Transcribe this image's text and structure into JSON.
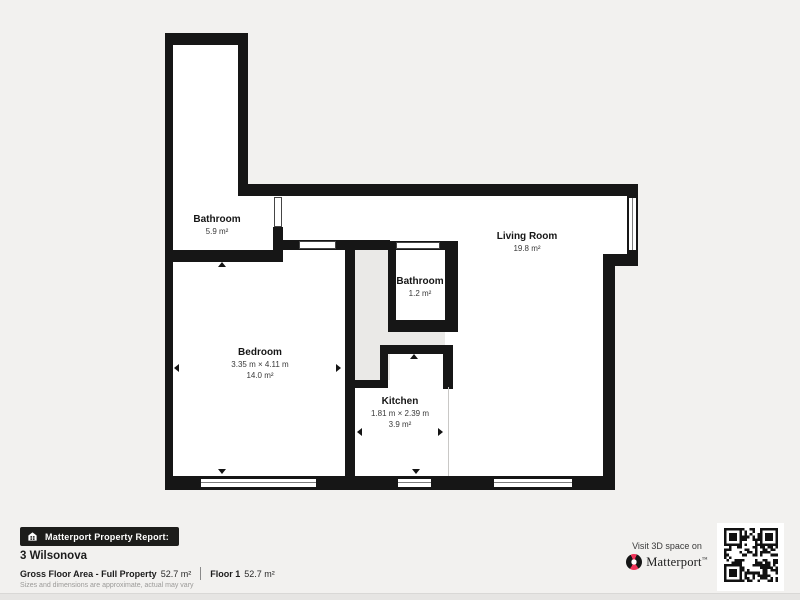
{
  "report": {
    "badge": "Matterport Property Report:",
    "property_name": "3 Wilsonova",
    "gross_floor_area_label": "Gross Floor Area - Full Property",
    "gross_floor_area_value": "52.7 m²",
    "floor_label": "Floor 1",
    "floor_value": "52.7 m²",
    "disclaimer": "Sizes and dimensions are approximate, actual may vary"
  },
  "rooms": {
    "bathroom_main": {
      "name": "Bathroom",
      "area": "5.9 m²"
    },
    "living_room": {
      "name": "Living Room",
      "area": "19.8 m²"
    },
    "bathroom_small": {
      "name": "Bathroom",
      "area": "1.2 m²"
    },
    "bedroom": {
      "name": "Bedroom",
      "dimensions": "3.35 m × 4.11 m",
      "area": "14.0 m²"
    },
    "kitchen": {
      "name": "Kitchen",
      "dimensions": "1.81 m × 2.39 m",
      "area": "3.9 m²"
    }
  },
  "cta": {
    "visit_text": "Visit 3D space on",
    "brand": "Matterport",
    "trademark": "™"
  },
  "icons": {
    "badge_icon": "house-icon",
    "logo": "matterport-logo-icon",
    "qr": "qr-code"
  },
  "colors": {
    "wall": "#161616",
    "background": "#f2f1ef",
    "room_fill": "#ffffff",
    "hallway_fill": "#eae9e7",
    "accent": "#ef3358",
    "badge_bg": "#1d1d1b"
  }
}
